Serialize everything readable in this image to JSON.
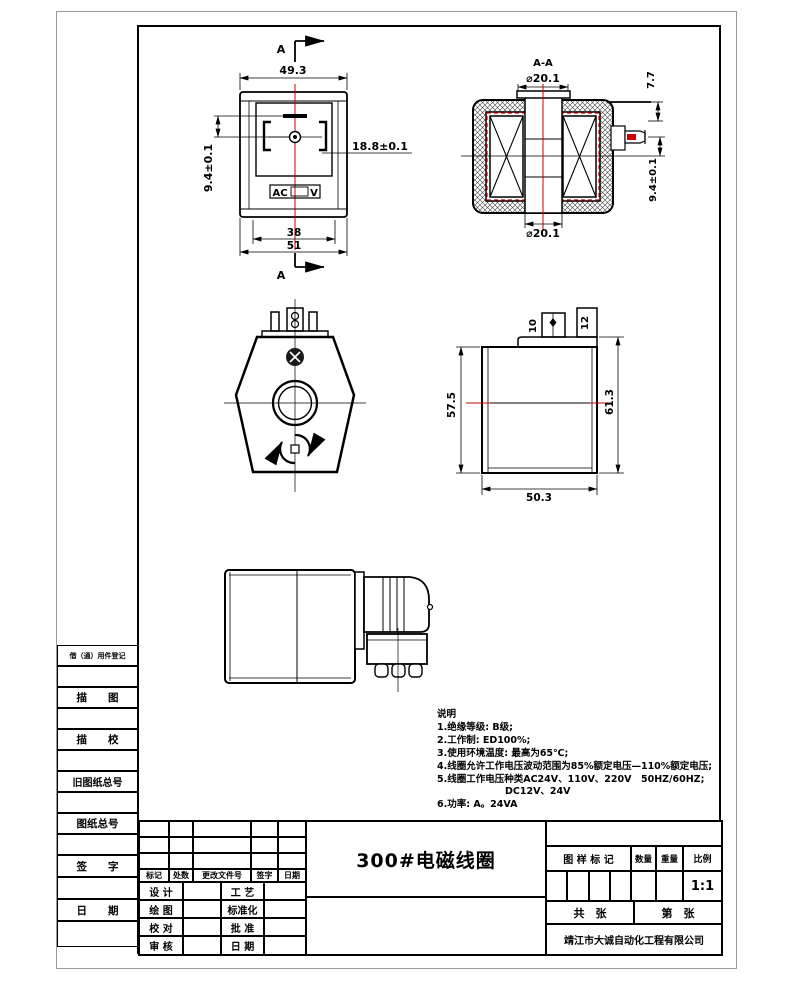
{
  "page": {
    "title": "300#电磁线圈",
    "company": "靖江市大诚自动化工程有限公司"
  },
  "sidebar": {
    "items": [
      {
        "label": "借（通）用件登记"
      },
      {
        "label": "描　　图"
      },
      {
        "label": "描　　校"
      },
      {
        "label": "旧图纸总号"
      },
      {
        "label": "图纸总号"
      },
      {
        "label": "签　　字"
      },
      {
        "label": "日　　期"
      }
    ]
  },
  "views": {
    "front": {
      "section_label": "A",
      "dims": {
        "top_width": "49.3",
        "pin_span": "18.8±0.1",
        "pin_offset": "9.4±0.1",
        "inner_width": "38",
        "outer_width": "51"
      },
      "plate": {
        "ac": "AC",
        "v": "V"
      }
    },
    "section": {
      "label": "A-A",
      "dims": {
        "bore_top": "⌀20.1",
        "bore_bottom": "⌀20.1",
        "lead_offset": "7.7",
        "terminal_offset": "9.4±0.1"
      }
    },
    "side": {
      "dims": {
        "pin1": "10",
        "pin2": "12",
        "height_left": "57.5",
        "height_right": "61.3",
        "bottom_width": "50.3"
      }
    }
  },
  "notes": {
    "heading": "说明",
    "lines": [
      "1.绝缘等级: B级;",
      "2.工作制: ED100%;",
      "3.使用环境温度: 最高为65℃;",
      "4.线圈允许工作电压波动范围为85%额定电压—110%额定电压;",
      "5.线圈工作电压种类AC24V、110V、220V　50HZ/60HZ;",
      "DC12V、24V",
      "6.功率: A。24VA"
    ]
  },
  "titleblock": {
    "revision_header": [
      "标记",
      "处数",
      "更改文件号",
      "签字",
      "日期"
    ],
    "roles": [
      {
        "left": "设 计",
        "right": "工 艺"
      },
      {
        "left": "绘 图",
        "right": "标准化"
      },
      {
        "left": "校 对",
        "right": "批 准"
      },
      {
        "left": "审 核",
        "right": "日 期"
      }
    ],
    "mark_header": "图 样 标 记",
    "qty_header": "数量",
    "weight_header": "重量",
    "scale_header": "比例",
    "scale_value": "1:1",
    "sheets_total": "共　张",
    "sheet_no": "第　张"
  }
}
